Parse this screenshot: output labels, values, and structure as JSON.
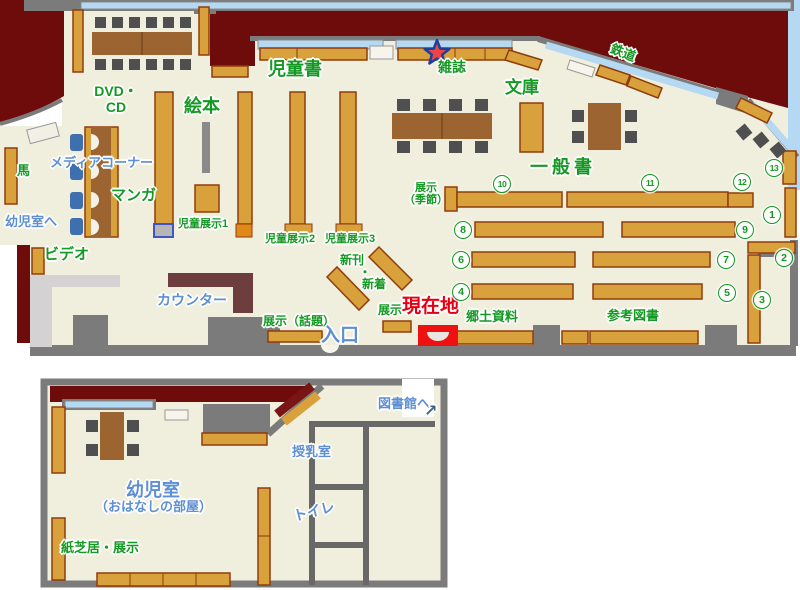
{
  "palette": {
    "floor": "#f0eedd",
    "backyard": "#6e0b0b",
    "wall": "#7b7b7b",
    "window": "#b5d9f2",
    "shelf": "#d9a13c",
    "shelf_border": "#8f3c0c",
    "table": "#9c6430",
    "chair": "#4f4f4f",
    "counter": "#6e3d3d",
    "lobby": "#d4d2d2",
    "media_chair": "#3e6fae",
    "green_label": "#149922",
    "blue_label": "#5d8fd2",
    "red_label": "#e60012",
    "marker_red": "#ee1111",
    "star_fill": "#ef4444",
    "star_border": "#1c3f9e"
  },
  "floor_map": {
    "sections": {
      "childrens_books": "児童書",
      "magazines": "雑誌",
      "bunko_paperbacks": "文庫",
      "railway": "鉄道",
      "picture_books": "絵本",
      "dvd_cd_line1": "DVD・",
      "dvd_cd_line2": "CD",
      "media_corner": "メディアコーナー",
      "manga": "マンガ",
      "horse": "馬",
      "to_infant_room": "幼児室へ",
      "video": "ビデオ",
      "counter": "カウンター",
      "child_exhibit_1": "児童展示1",
      "child_exhibit_2": "児童展示2",
      "child_exhibit_3": "児童展示3",
      "new_arrivals_line1": "新刊",
      "new_arrivals_dot": "・",
      "new_arrivals_line2": "新着",
      "exhibit": "展示",
      "current_location": "現在地",
      "exhibit_topic": "展示（話題）",
      "entrance": "入口",
      "local_materials": "郷土資料",
      "reference_books": "参考図書",
      "exhibit_season_line1": "展示",
      "exhibit_season_line2": "（季節）",
      "general_books": "一般書"
    },
    "shelf_numbers": {
      "n1": "1",
      "n2": "2",
      "n3": "3",
      "n4": "4",
      "n5": "5",
      "n6": "6",
      "n7": "7",
      "n8": "8",
      "n9": "9",
      "n10": "10",
      "n11": "11",
      "n12": "12",
      "n13": "13"
    }
  },
  "annex_map": {
    "sections": {
      "to_library": "図書館へ",
      "to_library_arrow": "↗",
      "nursing_room": "授乳室",
      "toilet": "トイレ",
      "infant_room": "幼児室",
      "infant_room_alt": "（おはなしの部屋）",
      "picture_story_exhibit": "紙芝居・展示"
    }
  }
}
